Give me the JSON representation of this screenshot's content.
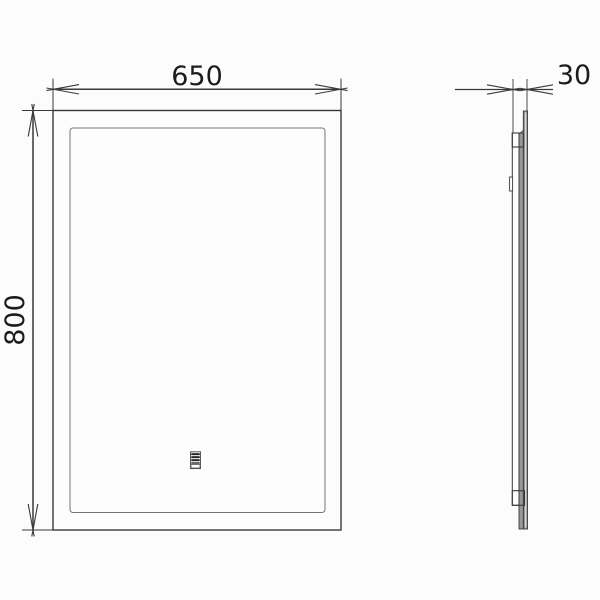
{
  "drawing": {
    "background_color": "#fcfcfc",
    "line_color": "#3a3a3a",
    "thin_line_color": "#757575",
    "glass_fill_color": "#989898",
    "dimensions": {
      "width_mm": "650",
      "height_mm": "800",
      "depth_mm": "30"
    },
    "views": {
      "front": "mirror front view with LED light band and touch sensor",
      "side": "mirror side profile view"
    },
    "icons": [
      {
        "name": "touch-sensor-icon"
      }
    ]
  }
}
